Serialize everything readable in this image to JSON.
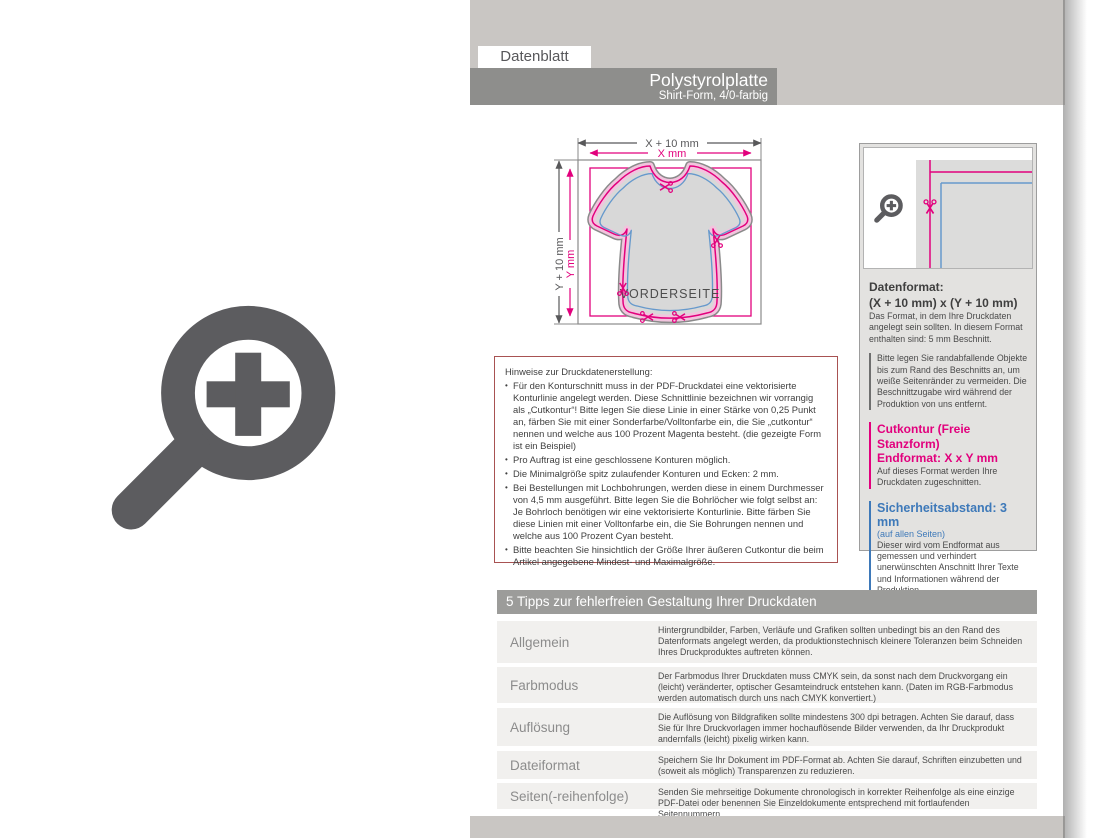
{
  "header": {
    "tab": "Datenblatt",
    "title": "Polystyrolplatte",
    "subtitle": "Shirt-Form, 4/0-farbig"
  },
  "diagram": {
    "dim_width_outer": "X + 10 mm",
    "dim_width_inner": "X mm",
    "dim_height_outer": "Y + 10 mm",
    "dim_height_inner": "Y mm",
    "front_label": "VORDERSEITE"
  },
  "notes_box": {
    "title": "Hinweise zur Druckdatenerstellung:",
    "bullets": [
      "Für den Konturschnitt muss in der PDF-Druckdatei eine vektorisierte Konturlinie angelegt werden. Diese Schnittlinie bezeichnen wir vorrangig als „Cutkontur“! Bitte legen Sie diese Linie in einer Stärke von 0,25 Punkt an, färben Sie mit einer Sonderfarbe/Volltonfarbe ein, die Sie „cutkontur“ nennen und welche aus 100 Prozent Magenta besteht. (die gezeigte Form ist ein Beispiel)",
      "Pro Auftrag ist eine geschlossene Konturen möglich.",
      "Die Minimalgröße spitz zulaufender Konturen und Ecken: 2 mm.",
      "Bei Bestellungen mit Lochbohrungen, werden diese in einem Durchmesser von 4,5 mm ausgeführt. Bitte legen Sie die Bohrlöcher wie folgt selbst an: Je Bohrloch benötigen wir eine vektorisierte Konturlinie. Bitte färben Sie diese Linien mit einer Volltonfarbe ein, die Sie Bohrungen nennen und welche aus 100 Prozent Cyan besteht.",
      "Bitte beachten Sie hinsichtlich der Größe Ihrer äußeren Cutkontur die beim Artikel angegebene Mindest- und Maximalgröße."
    ]
  },
  "info_panel": {
    "datenformat_title": "Datenformat:",
    "datenformat_value": "(X + 10 mm) x (Y + 10 mm)",
    "datenformat_desc": "Das Format, in dem Ihre Druckdaten angelegt sein sollten. In diesem Format enthalten sind: 5 mm Beschnitt.",
    "bleed_note": "Bitte legen Sie randabfallende Objekte bis zum Rand des Beschnitts an, um weiße Seitenränder zu vermeiden. Die Beschnittzugabe wird während der Produktion von uns entfernt.",
    "cutkontur_title": "Cutkontur (Freie Stanzform)",
    "cutkontur_value": "Endformat: X x Y mm",
    "cutkontur_desc": "Auf dieses Format werden Ihre Druckdaten zugeschnitten.",
    "safety_title": "Sicherheitsabstand: 3 mm",
    "safety_note": "(auf allen Seiten)",
    "safety_desc": "Dieser wird vom Endformat aus gemessen und verhindert unerwünschten Anschnitt Ihrer Texte und Informationen während der Produktion."
  },
  "tips": {
    "header": "5 Tipps zur fehlerfreien Gestaltung Ihrer Druckdaten",
    "rows": [
      {
        "label": "Allgemein",
        "text": "Hintergrundbilder, Farben, Verläufe und Grafiken sollten unbedingt bis an den Rand des Datenformats angelegt werden, da produktionstechnisch kleinere Toleranzen beim Schneiden Ihres Druckproduktes auftreten können."
      },
      {
        "label": "Farbmodus",
        "text": "Der Farbmodus Ihrer Druckdaten muss CMYK sein, da sonst nach dem Druckvorgang ein (leicht) veränderter, optischer Gesamteindruck entstehen kann. (Daten im RGB-Farbmodus werden automatisch durch uns nach CMYK konvertiert.)"
      },
      {
        "label": "Auflösung",
        "text": "Die Auflösung von Bildgrafiken sollte mindestens 300 dpi betragen. Achten Sie darauf, dass Sie für Ihre Druckvorlagen immer hochauflösende Bilder verwenden, da Ihr Druckprodukt andernfalls (leicht) pixelig wirken kann."
      },
      {
        "label": "Dateiformat",
        "text": "Speichern Sie Ihr Dokument im PDF-Format ab. Achten Sie darauf, Schriften einzubetten und (soweit als möglich) Transparenzen zu reduzieren."
      },
      {
        "label": "Seiten(-reihenfolge)",
        "text": "Senden Sie mehrseitige Dokumente chronologisch in korrekter Reihenfolge als eine einzige PDF-Datei oder benennen Sie Einzeldokumente entsprechend mit fortlaufenden Seitennummern."
      }
    ]
  },
  "colors": {
    "cut_magenta": "#e2007d",
    "safety_blue": "#3e79b9",
    "diagram_blue": "#6699cc",
    "notes_border_red": "#a85252",
    "icon_gray": "#5c5c5f"
  },
  "icons": {
    "large_zoom": "magnifier-plus",
    "small_zoom": "magnifier-plus",
    "cut_marker": "scissors"
  }
}
